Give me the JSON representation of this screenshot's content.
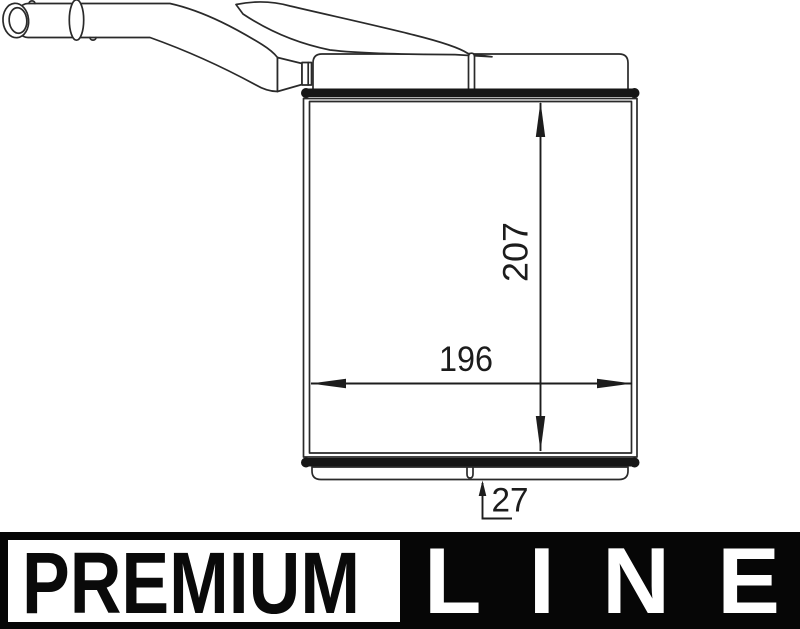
{
  "drawing": {
    "description": "heater-core-technical-drawing",
    "dimensions": {
      "height_label": "207",
      "width_label": "196",
      "depth_label": "27"
    },
    "line_color": "#2a2a2a",
    "bar_color": "#161616",
    "dimension_text_color": "#1c1c1c"
  },
  "banner": {
    "premium_label": "PREMIUM",
    "line_label": "LINE",
    "background": "#060606",
    "box_background": "#ffffff",
    "premium_text_color": "#0a0a0a",
    "line_text_color": "#ffffff"
  }
}
